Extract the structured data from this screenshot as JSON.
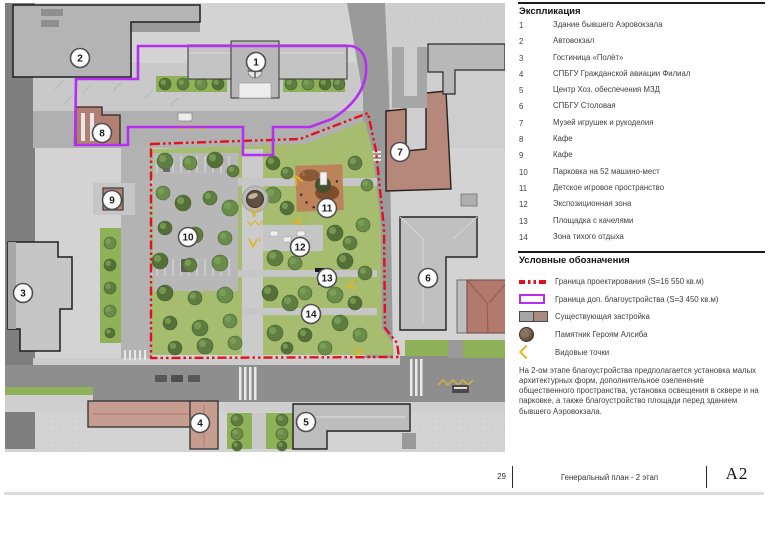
{
  "explication": {
    "title": "Экспликация",
    "items": [
      {
        "num": "1",
        "label": "Здание бывшего Аэровокзала"
      },
      {
        "num": "2",
        "label": "Автовокзал"
      },
      {
        "num": "3",
        "label": "Гостиница «Полёт»"
      },
      {
        "num": "4",
        "label": "СПБГУ Гражданской авиации Филиал"
      },
      {
        "num": "5",
        "label": "Центр Хоз. обеспечения МЗД"
      },
      {
        "num": "6",
        "label": "СПБГУ Столовая"
      },
      {
        "num": "7",
        "label": "Музей игрушек и рукоделия"
      },
      {
        "num": "8",
        "label": "Кафе"
      },
      {
        "num": "9",
        "label": "Кафе"
      },
      {
        "num": "10",
        "label": "Парковка на 52 машино-мест"
      },
      {
        "num": "11",
        "label": "Детское игровое пространство"
      },
      {
        "num": "12",
        "label": "Экспозиционная зона"
      },
      {
        "num": "13",
        "label": "Площадка с качелями"
      },
      {
        "num": "14",
        "label": "Зона тихого отдыха"
      }
    ]
  },
  "symbols": {
    "title": "Условные обозначения",
    "items": [
      {
        "icon": "boundary-design",
        "label": "Граница проектирования (S=16 550 кв.м)"
      },
      {
        "icon": "boundary-extra",
        "label": "Граница доп. благоустройства (S=3 450 кв.м)"
      },
      {
        "icon": "existing",
        "label": "Существующая застройка"
      },
      {
        "icon": "monument",
        "label": "Памятник Героям Алсиба"
      },
      {
        "icon": "viewpoints",
        "label": "Видовые точки"
      }
    ]
  },
  "note": "На 2-ом этапе благоустройства предполагается установка малых архитектурных форм, дополнительное озеленение общественного пространства, установка освещения в сквере и на парковке, а также благоустройство площади  перед зданием бывшего Аэровокзала.",
  "footer": {
    "page": "29",
    "title": "Генеральный план - 2 этап",
    "sheet": "А2"
  },
  "map": {
    "markers": [
      {
        "n": "1",
        "x": 251,
        "y": 59
      },
      {
        "n": "2",
        "x": 75,
        "y": 55
      },
      {
        "n": "3",
        "x": 18,
        "y": 290
      },
      {
        "n": "4",
        "x": 195,
        "y": 420
      },
      {
        "n": "5",
        "x": 301,
        "y": 419
      },
      {
        "n": "6",
        "x": 423,
        "y": 275
      },
      {
        "n": "7",
        "x": 395,
        "y": 149
      },
      {
        "n": "8",
        "x": 97,
        "y": 130
      },
      {
        "n": "9",
        "x": 107,
        "y": 197
      },
      {
        "n": "10",
        "x": 183,
        "y": 234
      },
      {
        "n": "11",
        "x": 322,
        "y": 205
      },
      {
        "n": "12",
        "x": 295,
        "y": 244
      },
      {
        "n": "13",
        "x": 322,
        "y": 275
      },
      {
        "n": "14",
        "x": 306,
        "y": 311
      }
    ],
    "viewpoints": [
      {
        "n": "2",
        "x": 249,
        "y": 210,
        "r": 0
      },
      {
        "n": "1",
        "x": 248,
        "y": 241,
        "r": 0
      },
      {
        "n": "5",
        "x": 292,
        "y": 176,
        "r": 150
      },
      {
        "n": "3",
        "x": 293,
        "y": 219,
        "r": -40
      },
      {
        "n": "4",
        "x": 345,
        "y": 283,
        "r": 70
      },
      {
        "n": "",
        "x": 354,
        "y": 349,
        "r": -90
      }
    ],
    "colors": {
      "boundary_design": "#e60f1e",
      "boundary_extra": "#b62ef2"
    }
  }
}
